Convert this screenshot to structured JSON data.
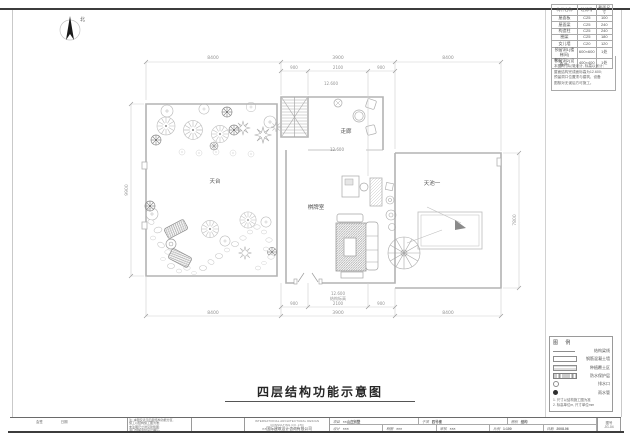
{
  "page": {
    "title": "四层结构功能示意图",
    "north_label": "北"
  },
  "plan": {
    "rooms": {
      "terrace_garden": "天台",
      "corridor": "走廊",
      "game_room": "棋牌室",
      "sky_pool": "天池一"
    },
    "elevations": {
      "corridor": "12.600",
      "roof": "12.600",
      "bottom_value": "12.600",
      "bottom_note": "结构标高"
    },
    "dims": {
      "top": [
        "8400",
        "3900",
        "8400"
      ],
      "top_sub": [
        "900",
        "2100",
        "900"
      ],
      "bottom_sub": [
        "900",
        "2100",
        "900"
      ],
      "bottom": [
        "8400",
        "3900",
        "8400"
      ],
      "left": "9900",
      "right": "7800"
    }
  },
  "area_table": {
    "headers": [
      "构件名称",
      "砼标号",
      "截面尺寸"
    ],
    "rows": [
      [
        "屋面板",
        "C25",
        "100"
      ],
      [
        "屋面梁",
        "C25",
        "240"
      ],
      [
        "构造柱",
        "C25",
        "240"
      ],
      [
        "圈梁",
        "C25",
        "180"
      ],
      [
        "女儿墙",
        "C20",
        "120"
      ],
      [
        "预留洞1(楼梯间)",
        "600×600",
        "1处"
      ],
      [
        "预留洞2(设备井)",
        "400×400",
        "1处"
      ]
    ],
    "note_title": "备注:",
    "note_lines": [
      "本图尺寸以毫米计, 标高以米计;",
      "屋面结构完成面标高为12.600;",
      "预留洞口位置须与建筑、设备",
      "图核对无误后方可施工。"
    ]
  },
  "legend": {
    "title": "图  例",
    "items": [
      {
        "label": "结构梁线"
      },
      {
        "label": "钢筋混凝土墙"
      },
      {
        "label": "种植覆土区"
      },
      {
        "label": "防水保护层"
      },
      {
        "label": "排水口"
      },
      {
        "label": "雨水管"
      }
    ],
    "notes": [
      "1. 尺寸以结构施工图为准",
      "2. 标高单位m, 尺寸单位mm"
    ]
  },
  "titleblock": {
    "sign_labels": [
      "会签",
      "日期"
    ],
    "note_lines": [
      "注: 本图仅表示四层结构功能分区,",
      "施工以结构施工图为准;",
      "未注明尺寸详见建筑图;",
      "洞口预留须经设计确认。"
    ],
    "company_en": "INTERNATIONAL ARCHITECTURAL DESIGN CONSULTING CO.,LTD",
    "company_cn": "××国际建筑设计咨询有限公司",
    "row1": [
      {
        "label": "项目",
        "value": "××山庄别墅"
      },
      {
        "label": "子项",
        "value": "四号楼"
      },
      {
        "label": "图别",
        "value": "结构"
      }
    ],
    "row2": [
      {
        "label": "设计",
        "value": "×××"
      },
      {
        "label": "制图",
        "value": "×××"
      },
      {
        "label": "审核",
        "value": "×××"
      },
      {
        "label": "比例",
        "value": "1:100"
      },
      {
        "label": "日期",
        "value": "2008.06"
      }
    ],
    "sheet": {
      "label": "图号",
      "value": "JG-04"
    }
  },
  "colors": {
    "plan_line": "#b3b3b3",
    "dark_line": "#3c3c3c",
    "text": "#555555"
  }
}
